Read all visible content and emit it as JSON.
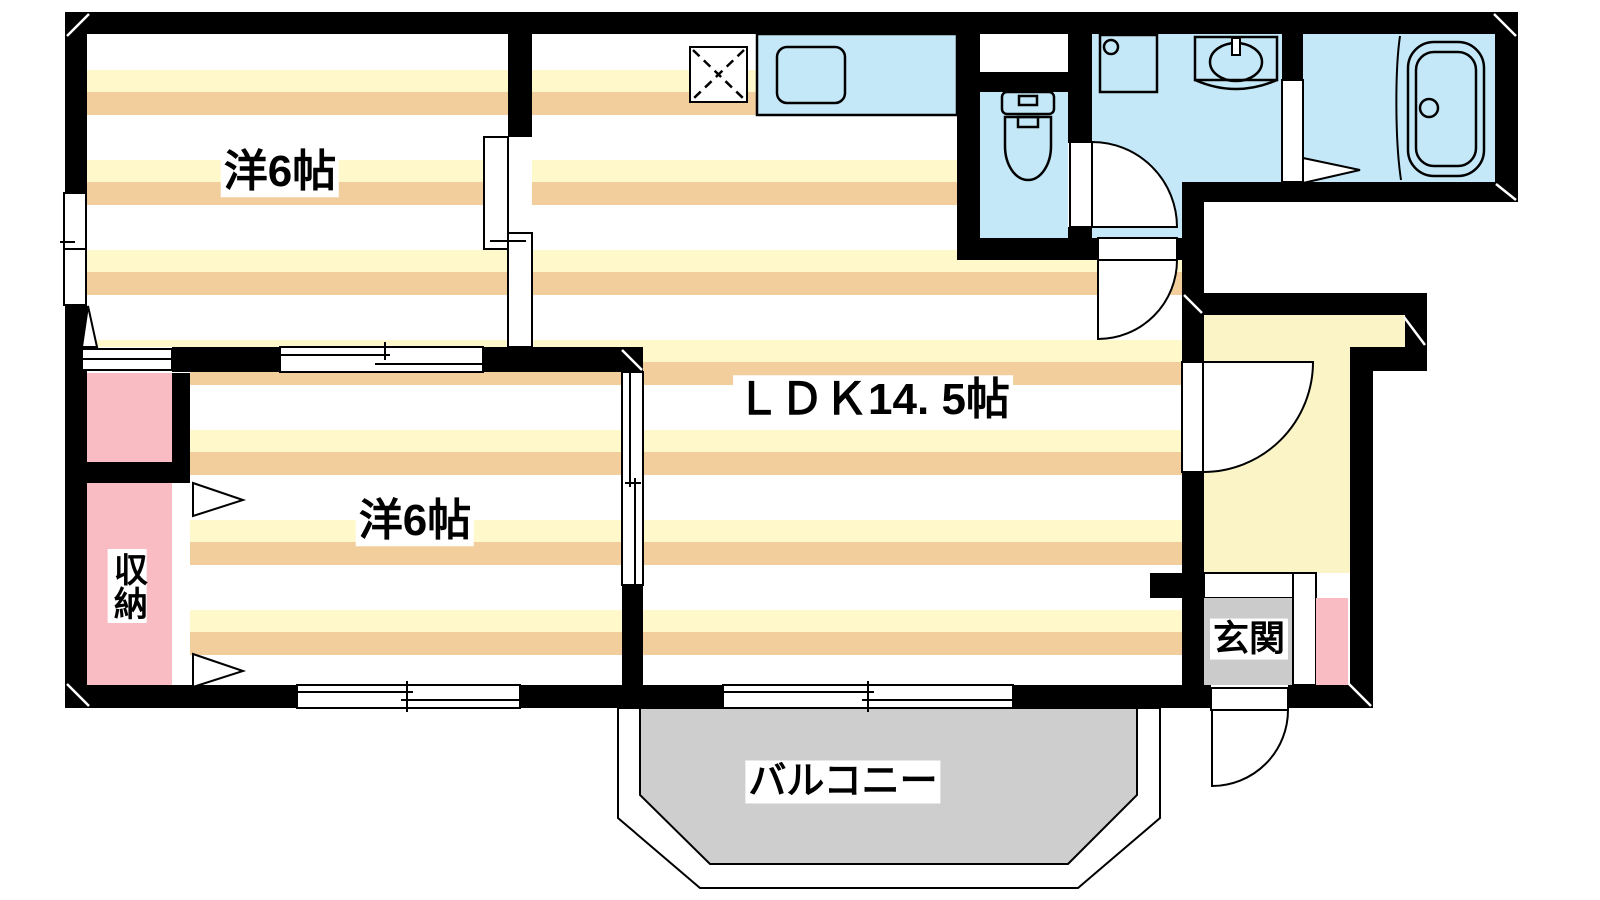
{
  "rooms": {
    "room1": {
      "label": "洋6帖"
    },
    "room2": {
      "label": "洋6帖"
    },
    "ldk": {
      "label": "ＬＤＫ14. 5帖"
    },
    "closet": {
      "label": "収納"
    },
    "genkan": {
      "label": "玄関"
    },
    "balcony": {
      "label": "バルコニー"
    }
  },
  "fixtures": [
    "kitchen-counter",
    "kitchen-sink",
    "range-space",
    "toilet",
    "washing-machine-pan",
    "vanity-basin",
    "bathtub",
    "bath-folding-door",
    "entry-door",
    "hallway-door",
    "washroom-door",
    "toilet-door",
    "balcony-sliding-window",
    "room-sliding-doors",
    "windows",
    "closet-folding-doors"
  ],
  "colors": {
    "wall": "#000000",
    "outline": "#000000",
    "stripe_yellow": "#FFF8CB",
    "stripe_tan": "#F2CE9C",
    "water_blue": "#C5E8F8",
    "closet_pink": "#F9BCC2",
    "hallway_yellow": "#FBF4C6",
    "genkan_gray": "#CBCBCB",
    "balcony_gray": "#CECECE"
  }
}
